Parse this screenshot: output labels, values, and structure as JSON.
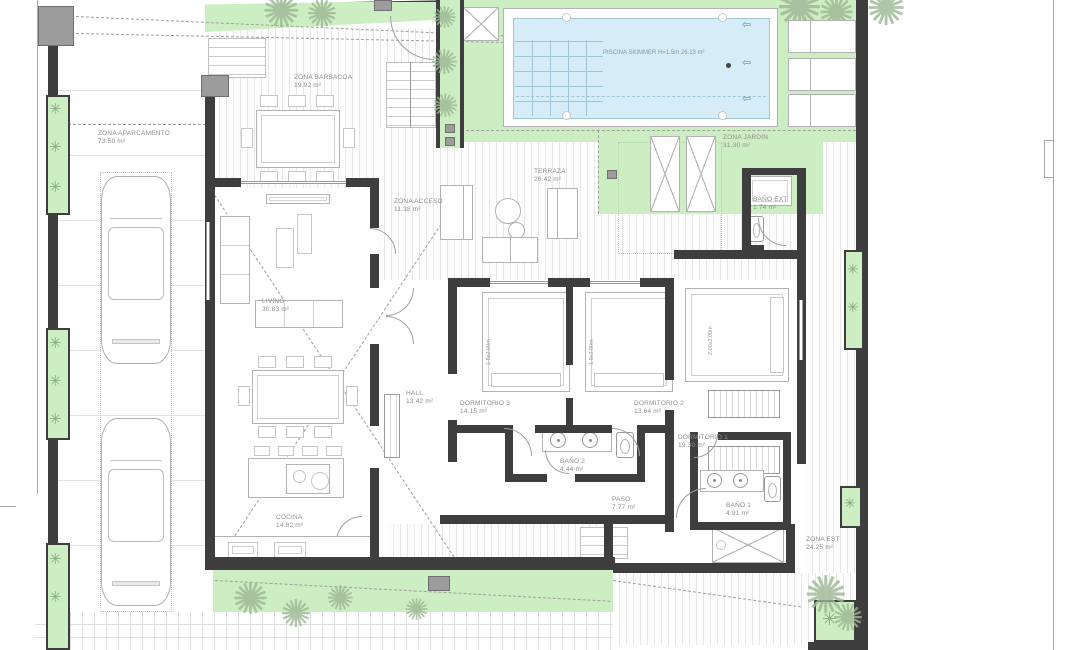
{
  "rooms": {
    "aparcamento": {
      "label": "ZONA APARCAMENTO",
      "area": "73.50 m²"
    },
    "barbacoa": {
      "label": "ZONA BARBACOA",
      "area": "19.92 m²"
    },
    "piscina": {
      "label": "PISCINA SKIMMER H=1.5m",
      "area": "26.13 m²"
    },
    "jardin": {
      "label": "ZONA JARDIN",
      "area": "31.30 m²"
    },
    "acceso": {
      "label": "ZONA ACCESO",
      "area": "11.38 m²"
    },
    "terraza": {
      "label": "TERRAZA",
      "area": "26.42 m²"
    },
    "bano_ext": {
      "label": "BAÑO EXT",
      "area": "1.74 m²"
    },
    "living": {
      "label": "LIVING",
      "area": "30.83 m²"
    },
    "cocina": {
      "label": "COCINA",
      "area": "14.82 m²"
    },
    "hall": {
      "label": "HALL",
      "area": "13.42 m²"
    },
    "dormitorio3": {
      "label": "DORMITORIO 3",
      "area": "14.15 m²"
    },
    "dormitorio2": {
      "label": "DORMITORIO 2",
      "area": "13.64 m²"
    },
    "dormitorio1": {
      "label": "DORMITORIO 1",
      "area": "19.30 m²"
    },
    "bano2": {
      "label": "BAÑO 2",
      "area": "4.44 m²"
    },
    "paso": {
      "label": "PASO",
      "area": "7.77 m²"
    },
    "bano1": {
      "label": "BAÑO 1",
      "area": "4.91 m²"
    },
    "zona_est": {
      "label": "ZONA EST",
      "area": "24.25 m²"
    }
  },
  "beds": {
    "dormitorio3": "1.8x2.00m",
    "dormitorio2": "1.8x2.00m",
    "dormitorio1": "2.00x2.00m"
  },
  "icons": {
    "palm": "✺",
    "plant": "✳",
    "pool_jet": "⇦"
  },
  "colors": {
    "wall": "#3e3e3e",
    "garden_green": "#cdeec2",
    "pool_water": "#d6ecf6",
    "drawing_line": "#b2b2b2"
  }
}
